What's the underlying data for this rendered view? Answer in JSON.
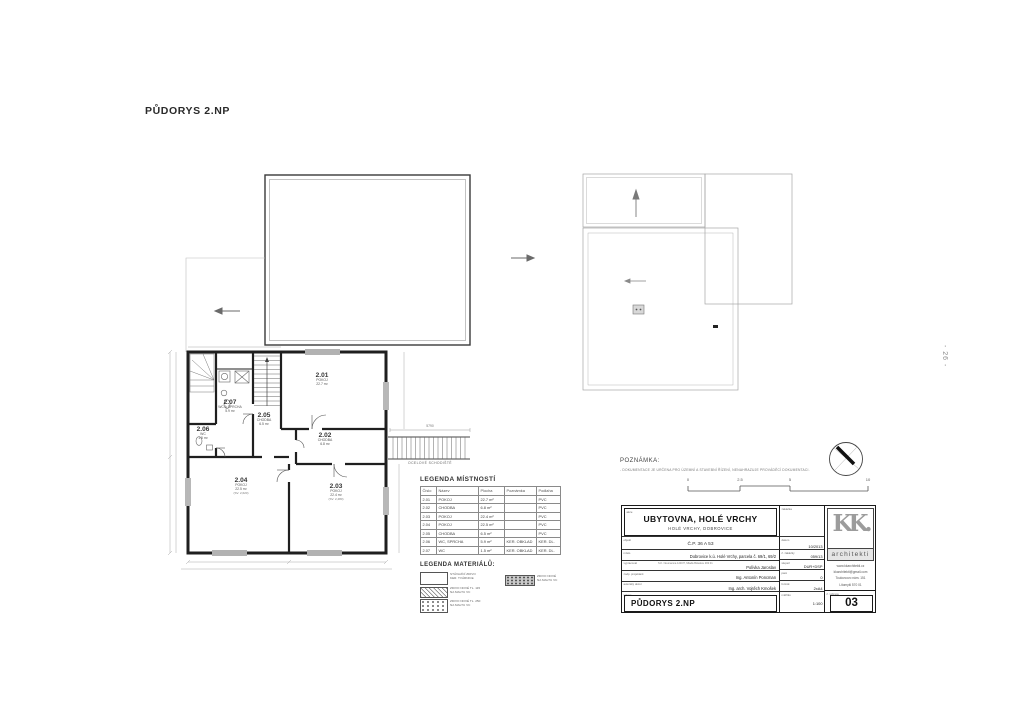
{
  "page": {
    "title": "PŮDORYS 2.NP",
    "page_number": "- 26 -"
  },
  "plan": {
    "rooms": [
      {
        "id": "2.01",
        "name": "POKOJ",
        "area": "22.7 m²",
        "note": ""
      },
      {
        "id": "2.02",
        "name": "CHODBA",
        "area": "6.8 m²",
        "note": ""
      },
      {
        "id": "2.03",
        "name": "POKOJ",
        "area": "22.4 m²",
        "note": "(SV. 2,480)"
      },
      {
        "id": "2.04",
        "name": "POKOJ",
        "area": "22.5 m²",
        "note": "(SV. 2,620)"
      },
      {
        "id": "2.05",
        "name": "CHODBA",
        "area": "6.5 m²",
        "note": ""
      },
      {
        "id": "2.06",
        "name": "WC",
        "area": "1.5 m²",
        "note": ""
      },
      {
        "id": "2.07",
        "name": "WC A SPRCHA",
        "area": "5.9 m²",
        "note": ""
      }
    ],
    "exterior_stair": {
      "label": "OCELOVÉ SCHODIŠTĚ",
      "dim": "5790"
    }
  },
  "legend_rooms": {
    "title": "LEGENDA MÍSTNOSTÍ",
    "headers": [
      "Číslo",
      "Název",
      "Plocha",
      "Poznámka",
      "Podlaha"
    ],
    "rows": [
      {
        "cislo": "2.01",
        "nazev": "POKOJ",
        "plocha": "22.7 m²",
        "poznamka": "",
        "podlaha": "PVC"
      },
      {
        "cislo": "2.02",
        "nazev": "CHODBA",
        "plocha": "6.8 m²",
        "poznamka": "",
        "podlaha": "PVC"
      },
      {
        "cislo": "2.03",
        "nazev": "POKOJ",
        "plocha": "22.4 m²",
        "poznamka": "",
        "podlaha": "PVC"
      },
      {
        "cislo": "2.04",
        "nazev": "POKOJ",
        "plocha": "22.5 m²",
        "poznamka": "",
        "podlaha": "PVC"
      },
      {
        "cislo": "2.05",
        "nazev": "CHODBA",
        "plocha": "6.5 m²",
        "poznamka": "",
        "podlaha": "PVC"
      },
      {
        "cislo": "2.06",
        "nazev": "WC, SPRCHA",
        "plocha": "5.9 m²",
        "poznamka": "KER. OBKLAD",
        "podlaha": "KER. DL."
      },
      {
        "cislo": "2.07",
        "nazev": "WC",
        "plocha": "1.5 m²",
        "poznamka": "KER. OBKLAD",
        "podlaha": "KER. DL."
      }
    ]
  },
  "legend_materials": {
    "title": "LEGENDA MATERIÁLŮ:",
    "items": [
      {
        "line1": "STÁVAJÍCÍ ZDIVO",
        "line2": "KER. TVÁRNICE"
      },
      {
        "line1": "ZDIVO NOVÉ TL. 115",
        "line2": "NA MALTU VC"
      },
      {
        "line1": "ZDIVO NOVÉ TL. 250",
        "line2": "NA MALTU VC"
      },
      {
        "line1": "ZDIVO NOVÉ",
        "line2": "NA MALTU VC"
      }
    ]
  },
  "note": {
    "title": "POZNÁMKA:",
    "text": "- DOKUMENTACE JE URČENA PRO ÚZEMNÍ A STAVEBNÍ ŘÍZENÍ, NENAHRAZUJE PROVÁDĚCÍ DOKUMENTACI."
  },
  "scalebar": {
    "labels": [
      "0",
      "2.5",
      "5",
      "10"
    ]
  },
  "titleblock": {
    "akce_label": "akce",
    "akce": "UBYTOVNA, HOLÉ VRCHY",
    "akce_sub": "HOLÉ VRCHY, DOBROVICE",
    "objekt_label": "objekt",
    "objekt": "Č.P. 36 A 53",
    "rows": [
      {
        "label": "místo",
        "sub": "",
        "value": "Dobrovice k.ú. Holé Vrchy, parcela č. 69/1, 69/2"
      },
      {
        "label": "vypracoval",
        "sub": "S.K. Neumanna 123/37, Mladá Boleslav 293 01",
        "value": "Polívka Jaroslav"
      },
      {
        "label": "zodp. projektant",
        "sub": "",
        "value": "Ing. Antonín Poncman"
      },
      {
        "label": "autorský dozor",
        "sub": "",
        "value": "Ing. arch. Vojtěch Kmošek"
      }
    ],
    "vykres_label": "výkres",
    "vykres": "PŮDORYS 2.NP",
    "meta": [
      {
        "label": "zakázka",
        "value": ""
      },
      {
        "label": "datum",
        "value": "10/2013"
      },
      {
        "label": "č. zakázky",
        "value": "059/13"
      },
      {
        "label": "stupeň",
        "value": "DUR+DSP"
      },
      {
        "label": "paré",
        "value": "0"
      },
      {
        "label": "formát",
        "value": "2xA4"
      },
      {
        "label": "měřítko",
        "value": "1:100"
      }
    ],
    "cislo_label": "č. výkresu",
    "cislo": "03",
    "logo": {
      "mark": "KK.",
      "name": "architekti",
      "web": "www.kkarchitekti.cz",
      "email": "kkarchitekti@gmail.com",
      "addr1": "Toulovcovo nám. 151",
      "addr2": "Litomyšl 570 01"
    }
  }
}
